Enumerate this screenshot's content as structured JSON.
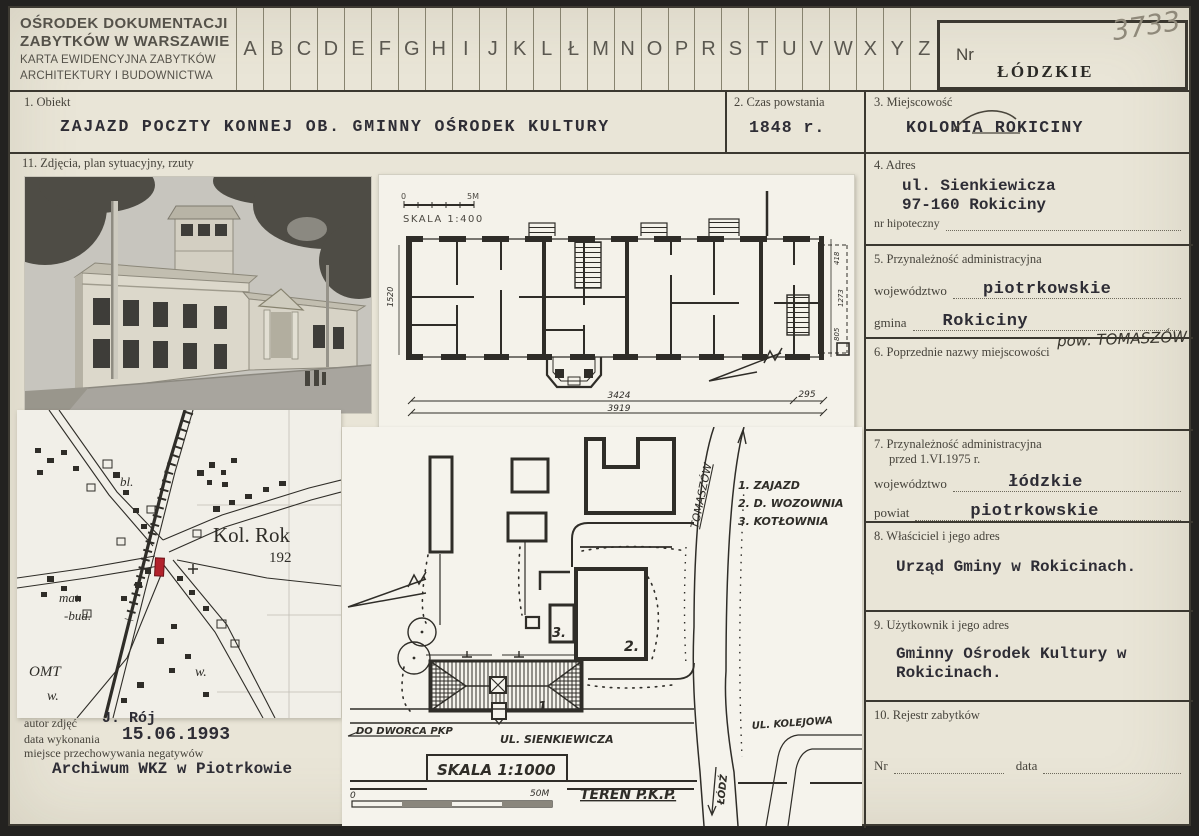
{
  "header": {
    "org_line1": "OŚRODEK DOKUMENTACJI",
    "org_line2": "ZABYTKÓW W WARSZAWIE",
    "org_line3": "KARTA EWIDENCYJNA ZABYTKÓW",
    "org_line4": "ARCHITEKTURY I BUDOWNICTWA",
    "alphabet": [
      "A",
      "B",
      "C",
      "D",
      "E",
      "F",
      "G",
      "H",
      "I",
      "J",
      "K",
      "L",
      "Ł",
      "M",
      "N",
      "O",
      "P",
      "R",
      "S",
      "T",
      "U",
      "V",
      "W",
      "X",
      "Y",
      "Z"
    ],
    "nr_label": "Nr",
    "nr_value_handwritten": "3733",
    "voivodeship_stamp": "ŁÓDZKIE"
  },
  "fields": {
    "obiekt": {
      "label": "1. Obiekt",
      "value": "ZAJAZD POCZTY KONNEJ OB. GMINNY OŚRODEK KULTURY"
    },
    "czas_powstania": {
      "label": "2. Czas powstania",
      "value": "1848 r."
    },
    "miejscowosc": {
      "label": "3. Miejscowość",
      "value": "KOLONIA ROKICINY"
    },
    "adres": {
      "label": "4. Adres",
      "line1": "ul. Sienkiewicza",
      "line2": "97-160 Rokiciny",
      "nr_hipoteczny_label": "nr hipoteczny"
    },
    "przynaleznosc": {
      "label": "5. Przynależność administracyjna",
      "wojewodztwo_label": "województwo",
      "wojewodztwo": "piotrkowskie",
      "gmina_label": "gmina",
      "gmina": "Rokiciny",
      "handwritten_note": "pow. TOMASZÓW"
    },
    "poprzednie_nazwy": {
      "label": "6. Poprzednie nazwy miejscowości"
    },
    "przynaleznosc_1975": {
      "label_line1": "7. Przynależność administracyjna",
      "label_line2": "przed 1.VI.1975 r.",
      "wojewodztwo_label": "województwo",
      "wojewodztwo": "łódzkie",
      "powiat_label": "powiat",
      "powiat": "piotrkowskie"
    },
    "wlasciciel": {
      "label": "8. Właściciel i jego adres",
      "value": "Urząd Gminy w Rokicinach."
    },
    "uzytkownik": {
      "label": "9. Użytkownik i jego adres",
      "line1": "Gminny Ośrodek Kultury w",
      "line2": "Rokicinach."
    },
    "rejestr": {
      "label": "10. Rejestr zabytków",
      "nr_label": "Nr",
      "data_label": "data"
    },
    "zdjecia": {
      "label": "11. Zdjęcia, plan sytuacyjny, rzuty"
    }
  },
  "photo_credits": {
    "author_label": "autor zdjęć",
    "author": "J. Rój",
    "date_label": "data wykonania",
    "date": "15.06.1993",
    "negatives_label": "miejsce przechowywania negatywów",
    "negatives_value": "Archiwum WKZ w Piotrkowie"
  },
  "floor_plan": {
    "scale_zero": "0",
    "scale_end": "5M",
    "scale_label": "SKALA 1:400",
    "dim_width_1": "3424",
    "dim_width_2": "3919",
    "dim_right": "295",
    "dim_left_side": "1520",
    "dim_side_1": "418",
    "dim_side_2": "1273",
    "dim_side_3": "805"
  },
  "site_plan": {
    "legend_1": "1. ZAJAZD",
    "legend_2": "2. D. WOZOWNIA",
    "legend_3": "3. KOTŁOWNIA",
    "road_to_tomaszow": "TOMASZÓW",
    "road_to_lodz": "ŁÓDŹ",
    "street_dworzec": "DO DWORCA PKP",
    "street_sienkiewicza": "UL. SIENKIEWICZA",
    "street_kolejowa": "UL. KOLEJOWA",
    "scale_label": "SKALA 1:1000",
    "scale_zero": "0",
    "scale_end": "50M",
    "area_pkp": "TEREN P.K.P.",
    "num_1": "1.",
    "num_2": "2.",
    "num_3": "3."
  },
  "map": {
    "label_bl": "bl.",
    "label_kol": "Kol. Rok",
    "label_num": "192",
    "label_mat": "mat.",
    "label_bud": "-bud.",
    "label_omt": "OMT",
    "label_w1": "w.",
    "label_w2": "w."
  },
  "colors": {
    "card_bg": "#e9e5d7",
    "paper_bg": "#f4f2ea",
    "ink": "#2f2d28",
    "typed_ink": "#2e2d35",
    "marker_red": "#b2222c"
  }
}
